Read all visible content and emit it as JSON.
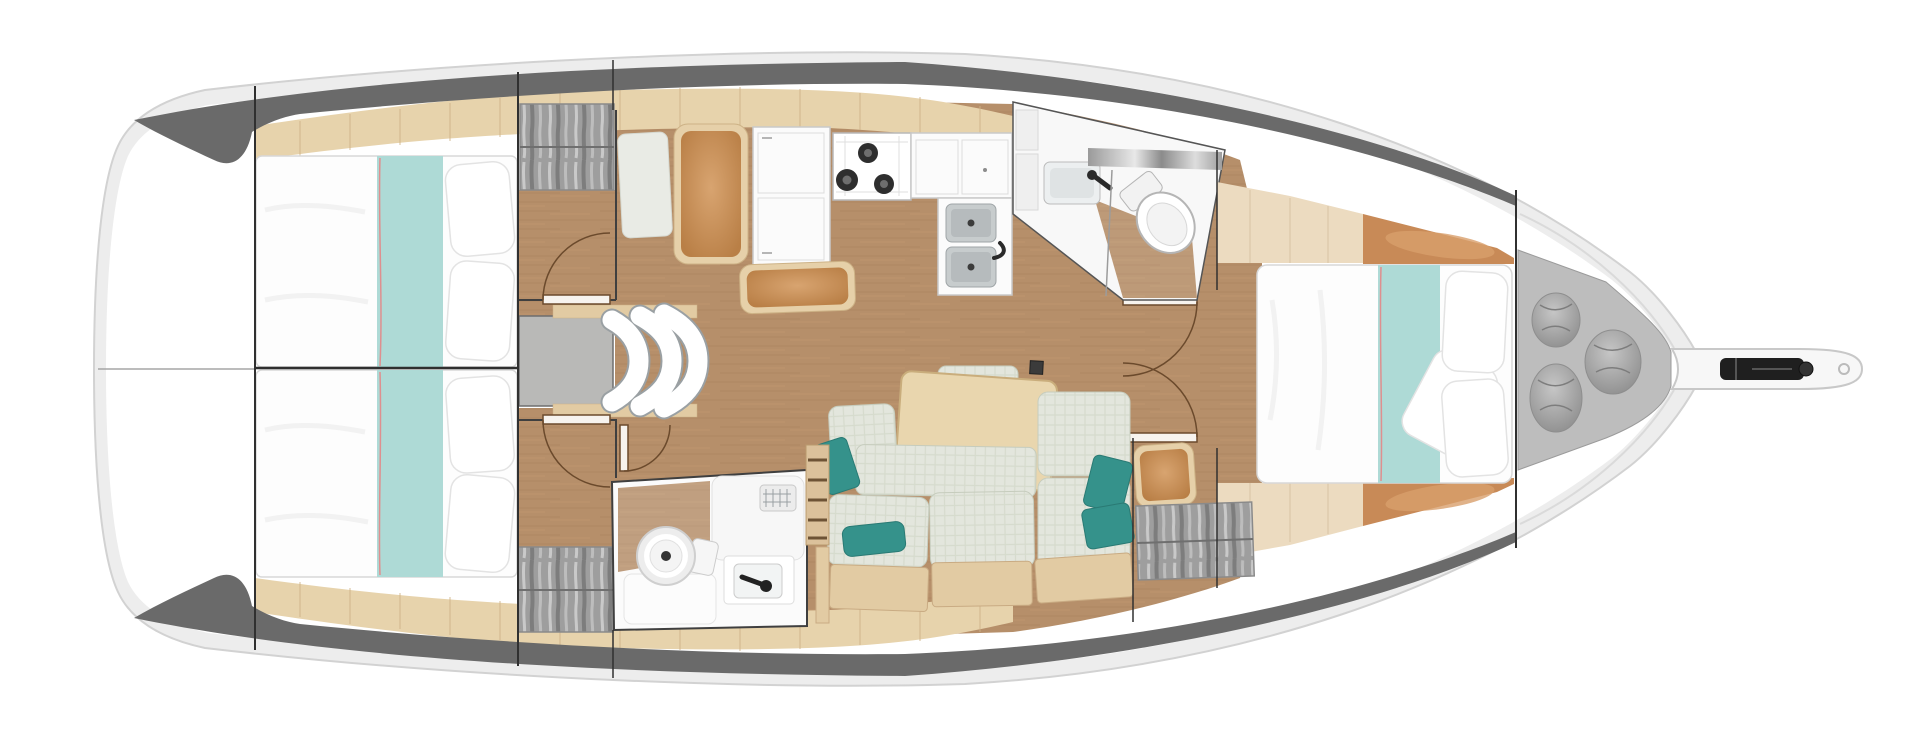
{
  "diagram": {
    "type": "yacht-interior-floorplan",
    "orientation": "bow-right",
    "background": "#ffffff"
  },
  "palette": {
    "hull_rim": "#ededed",
    "hull_outline": "#d2d2d2",
    "hull_white": "#ffffff",
    "band_dark": "#6a6a6a",
    "deck_wood": "#e7d3ac",
    "deck_seam": "#cdb286",
    "floor_wood": "#b68f6a",
    "berth_white": "#fdfdfd",
    "runner_teal": "#aedad6",
    "runner_stripe": "#df8f8f",
    "locker_gray": "#9e9e9e",
    "module_gray": "#b9b9b7",
    "counter_white": "#fbfbfb",
    "burner_black": "#2e2e2e",
    "sink_steel": "#c7cccd",
    "cushion_orange": "#c2854f",
    "cushion_rim": "#e6d0a9",
    "sofa_fabric": "#e3e6dd",
    "pillow_teal": "#35928b",
    "table_wood": "#e9d6ae",
    "sail_locker_gray": "#bdbdbd",
    "bag_gray": "#a9a9a9",
    "anchor_black": "#1f1f1f",
    "door_trace": "#6b4a2c",
    "bulkhead": "#303030"
  },
  "regions": {
    "stern_platform": {
      "features": []
    },
    "aft_cabin_port": {
      "features": [
        "double-berth",
        "teal-runner",
        "pillows",
        "hanging-locker",
        "door"
      ]
    },
    "aft_cabin_starboard": {
      "features": [
        "double-berth",
        "teal-runner",
        "pillows",
        "hanging-locker",
        "door"
      ]
    },
    "companionway": {
      "features": [
        "curved-steps",
        "engine-box-platform",
        "handrail-shelves"
      ]
    },
    "galley": {
      "features": [
        "nav-seat",
        "refrigerator",
        "three-burner-stove",
        "counter",
        "double-sink",
        "bench-seat"
      ]
    },
    "aft_head": {
      "features": [
        "toilet",
        "washbasin",
        "mirror",
        "shower-partition",
        "door"
      ]
    },
    "salon": {
      "features": [
        "l-shaped-settee",
        "teal-pillows",
        "dining-table",
        "mast-foot",
        "double-doors"
      ]
    },
    "forward_head": {
      "features": [
        "toilet",
        "washbasin",
        "shower-tray-drain",
        "teak-floor",
        "ladder-slats",
        "door"
      ]
    },
    "forward_cabin": {
      "features": [
        "island-double-berth",
        "teal-runner",
        "pillows",
        "bench-seat",
        "hanging-locker",
        "side-decks"
      ]
    },
    "sail_locker": {
      "features": [
        "storage-bag",
        "storage-bag",
        "storage-bag"
      ]
    },
    "bow": {
      "features": [
        "bowsprit",
        "anchor-roller",
        "mooring-hole"
      ]
    }
  }
}
